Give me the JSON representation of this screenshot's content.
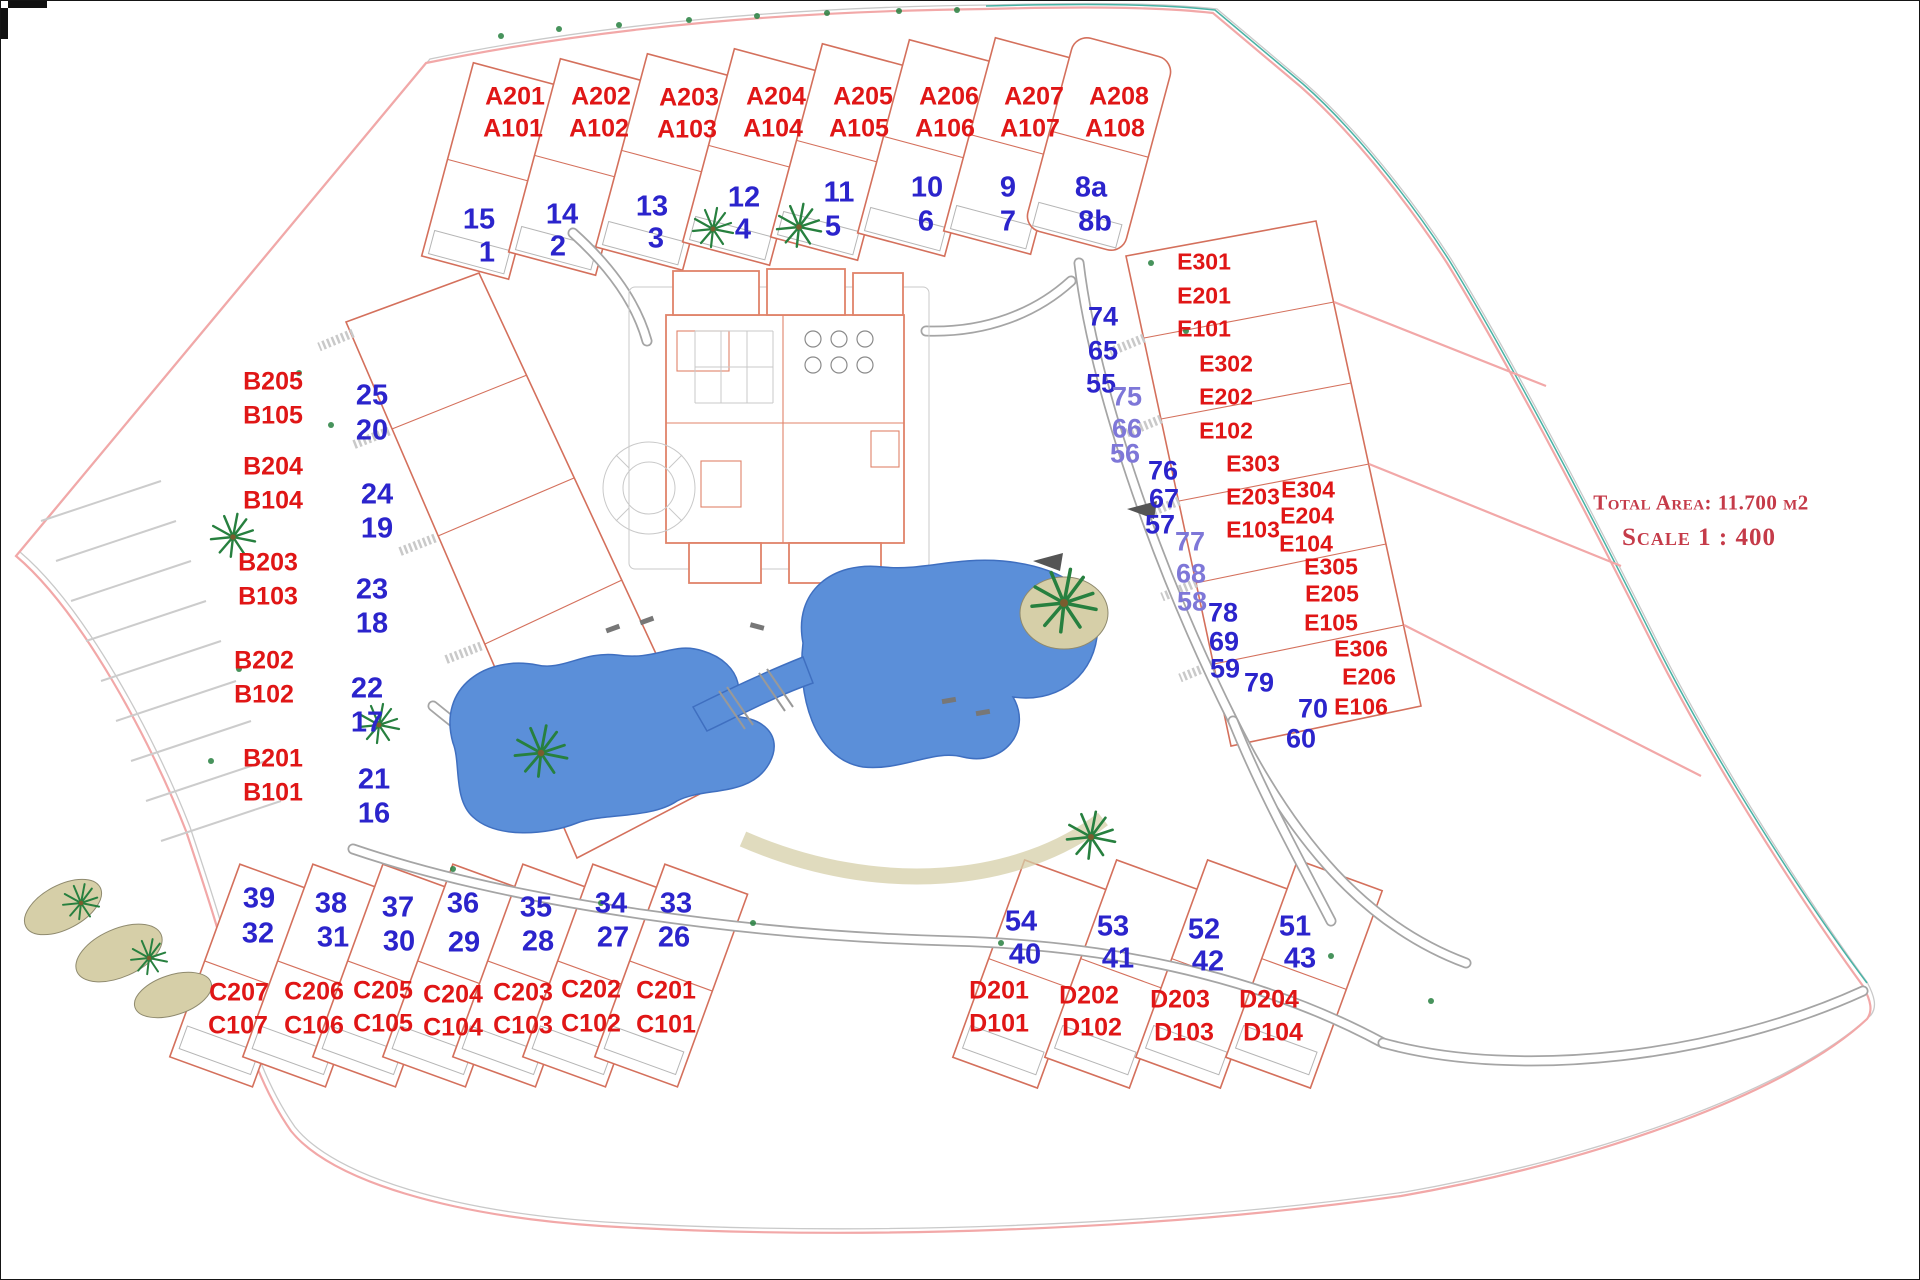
{
  "info": {
    "total_area": "Total Area:  11.700 м2",
    "scale": "Scale 1 : 400"
  },
  "blocks": {
    "a": {
      "upper": [
        "A201",
        "A202",
        "A203",
        "A204",
        "A205",
        "A206",
        "A207",
        "A208"
      ],
      "lower": [
        "A101",
        "A102",
        "A103",
        "A104",
        "A105",
        "A106",
        "A107",
        "A108"
      ],
      "plots_upper": [
        "15",
        "14",
        "13",
        "12",
        "11",
        "10",
        "9",
        "8a"
      ],
      "plots_lower": [
        "1",
        "2",
        "3",
        "4",
        "5",
        "6",
        "7",
        "8b"
      ]
    },
    "b": {
      "upper": [
        "B205",
        "B204",
        "B203",
        "B202",
        "B201"
      ],
      "lower": [
        "B105",
        "B104",
        "B103",
        "B102",
        "B101"
      ],
      "plots_upper": [
        "25",
        "24",
        "23",
        "22",
        "21"
      ],
      "plots_lower": [
        "20",
        "19",
        "18",
        "17",
        "16"
      ]
    },
    "c": {
      "upper": [
        "C207",
        "C206",
        "C205",
        "C204",
        "C203",
        "C202",
        "C201"
      ],
      "lower": [
        "C107",
        "C106",
        "C105",
        "C104",
        "C103",
        "C102",
        "C101"
      ],
      "plots_upper": [
        "39",
        "38",
        "37",
        "36",
        "35",
        "34",
        "33"
      ],
      "plots_lower": [
        "32",
        "31",
        "30",
        "29",
        "28",
        "27",
        "26"
      ]
    },
    "d": {
      "upper": [
        "D201",
        "D202",
        "D203",
        "D204"
      ],
      "lower": [
        "D101",
        "D102",
        "D103",
        "D104"
      ],
      "plots_upper": [
        "54",
        "53",
        "52",
        "51"
      ],
      "plots_lower": [
        "40",
        "41",
        "42",
        "43"
      ]
    },
    "e": {
      "units": [
        "E301",
        "E201",
        "E101",
        "E302",
        "E202",
        "E102",
        "E303",
        "E203",
        "E103",
        "E304",
        "E204",
        "E104",
        "E305",
        "E205",
        "E105",
        "E306",
        "E206",
        "E106"
      ],
      "plots": [
        "74",
        "65",
        "55",
        "75",
        "66",
        "56",
        "76",
        "67",
        "57",
        "77",
        "68",
        "58",
        "78",
        "69",
        "59",
        "79",
        "70",
        "60"
      ]
    }
  },
  "colors": {
    "unit_label": "#e01616",
    "plot_label": "#2b24cc",
    "plot_label_light": "#7e77d8",
    "building_outline": "#d4705c",
    "pool_fill": "#5b8fd9",
    "pool_stroke": "#3f6fc0",
    "path_gray": "#a5a5a5",
    "boundary_pink": "#f2a8a8",
    "boundary_teal": "#49b3a5",
    "tree_green": "#27803f",
    "island_tan": "#d6cfa8",
    "info_red": "#c53b49"
  }
}
